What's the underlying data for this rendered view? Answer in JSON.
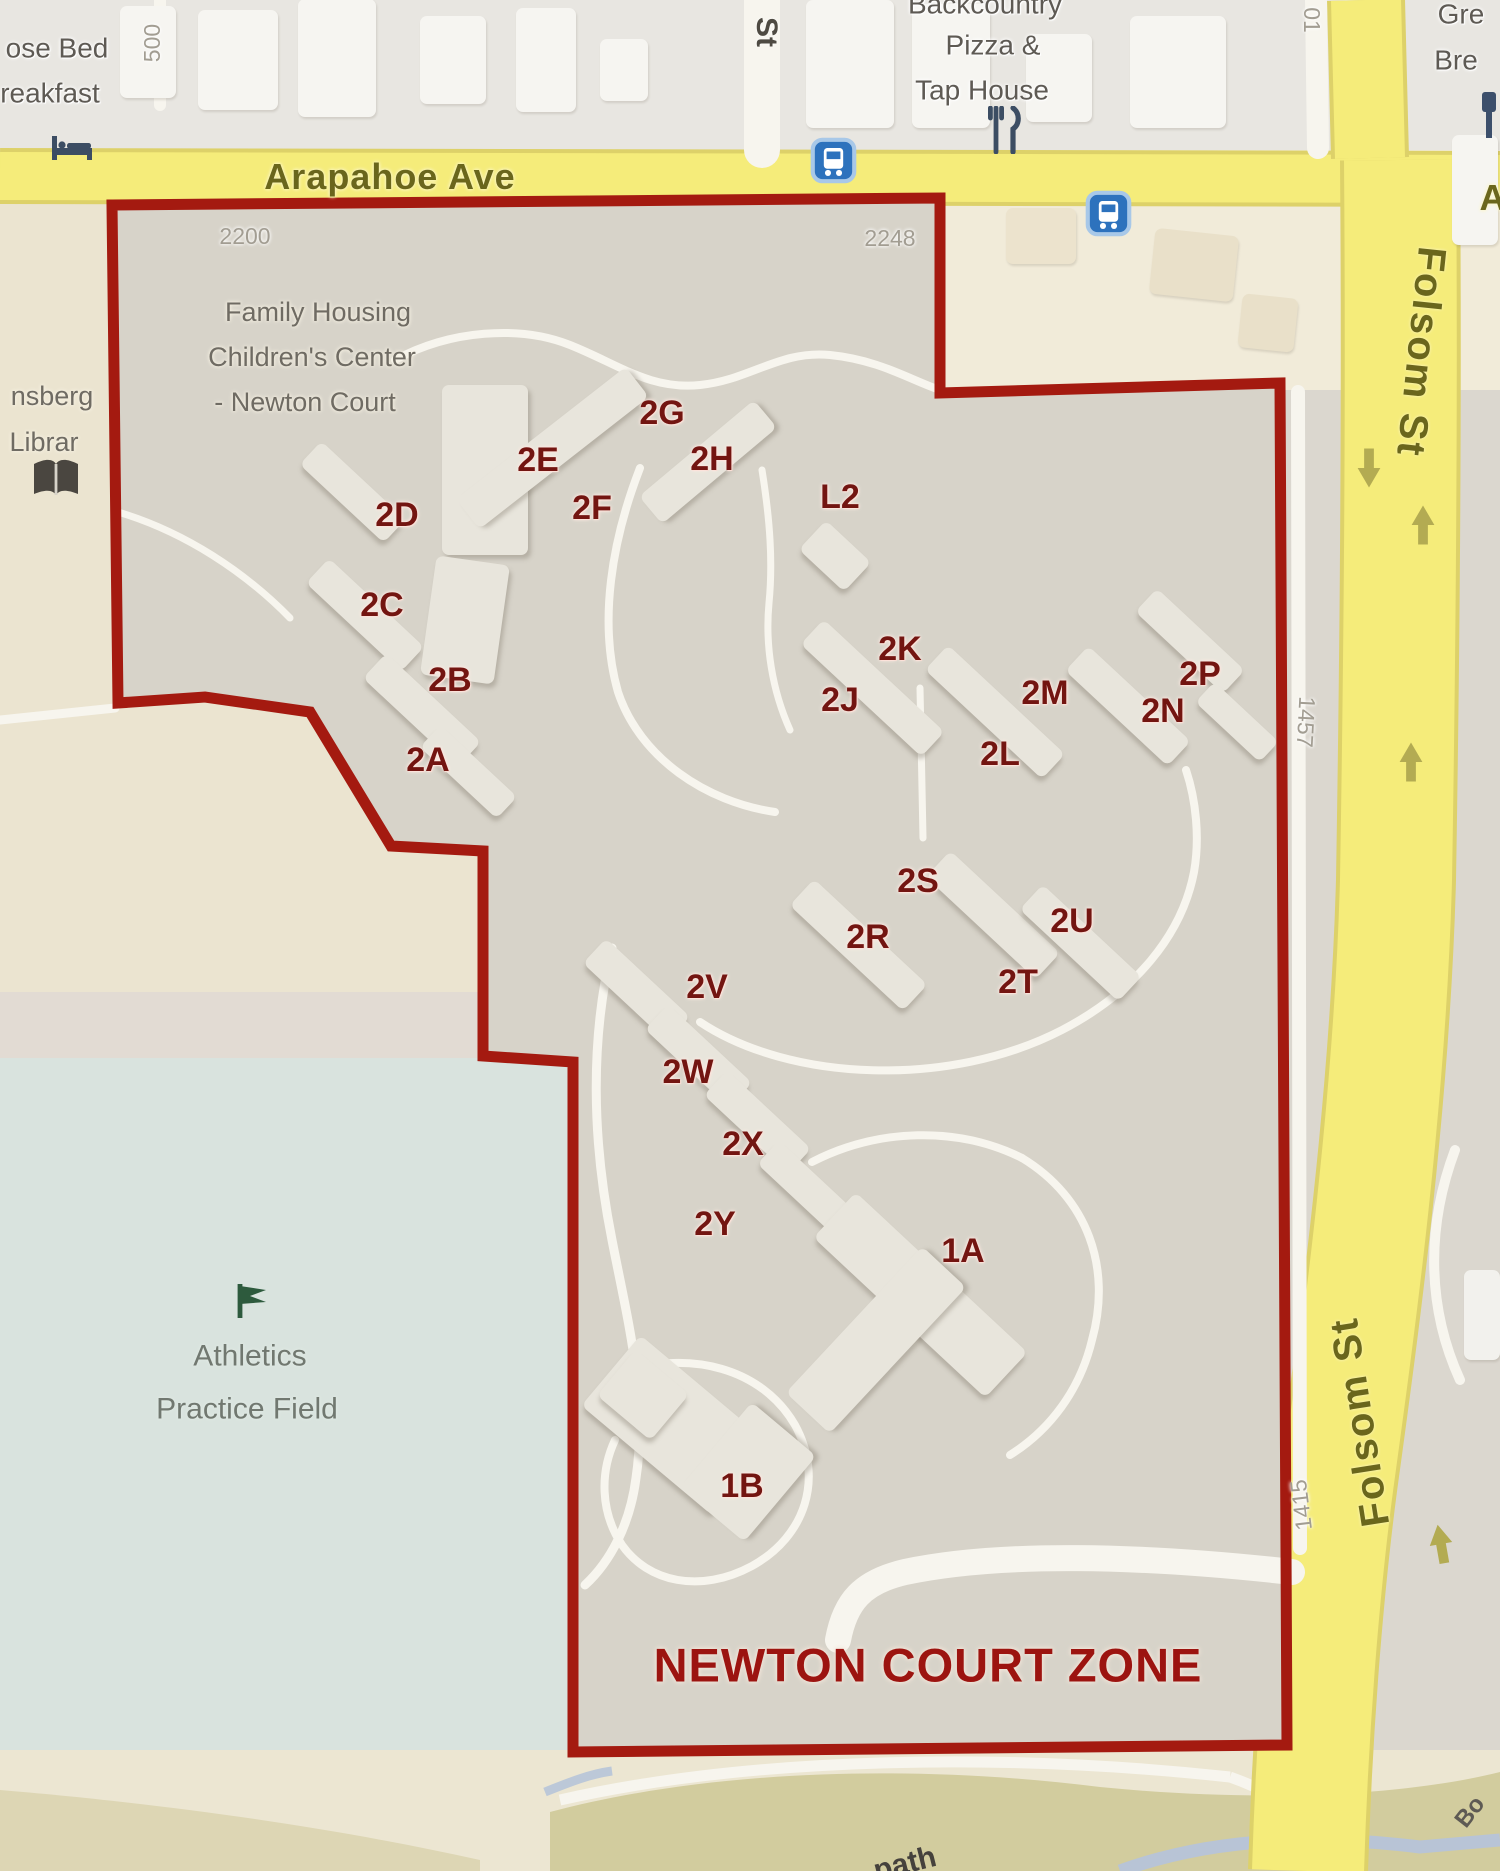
{
  "map": {
    "title": "NEWTON COURT ZONE",
    "colors": {
      "zone_fill": "#d7d3c9",
      "boundary_red": "#a41a10",
      "road_yellow": "#f5ec7a",
      "field_blue_green": "#d9e3de",
      "building_label_red": "#731511",
      "street_label_olive": "#6a661c",
      "cream_outside": "#ebe4d0",
      "creek_blue": "#b8c4d6"
    },
    "streets": [
      {
        "label": "Arapahoe Ave"
      },
      {
        "label": "Folsom St"
      },
      {
        "label": "Folsom St"
      },
      {
        "label": "St"
      },
      {
        "label": "A"
      }
    ],
    "street_numbers": [
      "2200",
      "2248",
      "500",
      "01",
      "1457",
      "1415"
    ],
    "pois": [
      {
        "name": "bed-and-breakfast",
        "lines": [
          "ose Bed",
          "reakfast"
        ]
      },
      {
        "name": "pizza-tap-house",
        "lines": [
          "Backcountry",
          "Pizza &",
          "Tap House"
        ]
      },
      {
        "name": "brewery",
        "lines": [
          "Gre",
          "Bre"
        ]
      },
      {
        "name": "library",
        "lines": [
          "nsberg",
          "Librar"
        ]
      },
      {
        "name": "family-housing",
        "lines": [
          "Family Housing",
          "Children's Center",
          "- Newton Court"
        ]
      },
      {
        "name": "athletics-field",
        "lines": [
          "Athletics",
          "Practice Field"
        ]
      },
      {
        "name": "creek-path",
        "lines": [
          "path"
        ]
      },
      {
        "name": "boulder-creek",
        "lines": [
          "Bo"
        ]
      }
    ],
    "zone_buildings": [
      "2A",
      "2B",
      "2C",
      "2D",
      "2E",
      "2F",
      "2G",
      "2H",
      "L2",
      "2J",
      "2K",
      "2L",
      "2M",
      "2N",
      "2P",
      "2R",
      "2S",
      "2T",
      "2U",
      "2V",
      "2W",
      "2X",
      "2Y",
      "1A",
      "1B"
    ]
  },
  "labels": [
    {
      "name": "street-label-arapahoe",
      "text": "Arapahoe Ave",
      "x": 390,
      "y": 177,
      "cls": "street"
    },
    {
      "name": "street-label-arapahoe-east",
      "text": "A",
      "x": 1493,
      "y": 198,
      "cls": "street"
    },
    {
      "name": "street-label-folsom-top",
      "text": "Folsom St",
      "x": 1421,
      "y": 352,
      "cls": "streetv",
      "rot": 96
    },
    {
      "name": "street-label-folsom-bottom",
      "text": "Folsom St",
      "x": 1360,
      "y": 1422,
      "cls": "streetv",
      "rot": -99
    },
    {
      "name": "street-label-st",
      "text": "St",
      "x": 766,
      "y": 32,
      "cls": "stv",
      "rot": 90
    },
    {
      "name": "address-2200",
      "text": "2200",
      "x": 245,
      "y": 236,
      "cls": "num"
    },
    {
      "name": "address-2248",
      "text": "2248",
      "x": 890,
      "y": 238,
      "cls": "num"
    },
    {
      "name": "address-500",
      "text": "500",
      "x": 152,
      "y": 43,
      "cls": "num",
      "rot": -90
    },
    {
      "name": "address-01",
      "text": "01",
      "x": 1312,
      "y": 20,
      "cls": "num",
      "rot": 90
    },
    {
      "name": "address-1457",
      "text": "1457",
      "x": 1306,
      "y": 722,
      "cls": "num",
      "rot": 93
    },
    {
      "name": "address-1415",
      "text": "1415",
      "x": 1301,
      "y": 1505,
      "cls": "num",
      "rot": -97
    },
    {
      "name": "poi-bed-breakfast-1",
      "text": "ose Bed",
      "x": 57,
      "y": 48,
      "cls": "poi"
    },
    {
      "name": "poi-bed-breakfast-2",
      "text": "reakfast",
      "x": 50,
      "y": 93,
      "cls": "poi"
    },
    {
      "name": "poi-pizza-1",
      "text": "Backcountry",
      "x": 985,
      "y": 4,
      "cls": "poi"
    },
    {
      "name": "poi-pizza-2",
      "text": "Pizza &",
      "x": 993,
      "y": 45,
      "cls": "poi"
    },
    {
      "name": "poi-pizza-3",
      "text": "Tap House",
      "x": 982,
      "y": 90,
      "cls": "poi"
    },
    {
      "name": "poi-brewery-1",
      "text": "Gre",
      "x": 1461,
      "y": 14,
      "cls": "poi"
    },
    {
      "name": "poi-brewery-2",
      "text": "Bre",
      "x": 1456,
      "y": 60,
      "cls": "poi"
    },
    {
      "name": "poi-library-1",
      "text": "nsberg",
      "x": 52,
      "y": 396,
      "cls": "poi2"
    },
    {
      "name": "poi-library-2",
      "text": "Librar",
      "x": 44,
      "y": 442,
      "cls": "poi2"
    },
    {
      "name": "poi-family-housing-1",
      "text": "Family Housing",
      "x": 318,
      "y": 312,
      "cls": "poi2"
    },
    {
      "name": "poi-family-housing-2",
      "text": "Children's Center",
      "x": 312,
      "y": 357,
      "cls": "poi2"
    },
    {
      "name": "poi-family-housing-3",
      "text": "- Newton Court",
      "x": 305,
      "y": 402,
      "cls": "poi2"
    },
    {
      "name": "poi-athletics-1",
      "text": "Athletics",
      "x": 250,
      "y": 1356,
      "cls": "ath"
    },
    {
      "name": "poi-athletics-2",
      "text": "Practice Field",
      "x": 247,
      "y": 1409,
      "cls": "ath"
    },
    {
      "name": "poi-path",
      "text": "path",
      "x": 905,
      "y": 1864,
      "cls": "pth",
      "rot": -14
    },
    {
      "name": "poi-bo",
      "text": "Bo",
      "x": 1470,
      "y": 1812,
      "cls": "bo",
      "rot": -52
    },
    {
      "name": "zone-title",
      "text": "NEWTON COURT ZONE",
      "x": 928,
      "y": 1665,
      "cls": "zone"
    },
    {
      "name": "building-label-2E",
      "text": "2E",
      "x": 538,
      "y": 461,
      "cls": "bld"
    },
    {
      "name": "building-label-2F",
      "text": "2F",
      "x": 592,
      "y": 509,
      "cls": "bld"
    },
    {
      "name": "building-label-2G",
      "text": "2G",
      "x": 662,
      "y": 414,
      "cls": "bld"
    },
    {
      "name": "building-label-2H",
      "text": "2H",
      "x": 712,
      "y": 460,
      "cls": "bld"
    },
    {
      "name": "building-label-L2",
      "text": "L2",
      "x": 840,
      "y": 498,
      "cls": "bld"
    },
    {
      "name": "building-label-2D",
      "text": "2D",
      "x": 397,
      "y": 516,
      "cls": "bld"
    },
    {
      "name": "building-label-2C",
      "text": "2C",
      "x": 382,
      "y": 606,
      "cls": "bld"
    },
    {
      "name": "building-label-2B",
      "text": "2B",
      "x": 450,
      "y": 681,
      "cls": "bld"
    },
    {
      "name": "building-label-2A",
      "text": "2A",
      "x": 428,
      "y": 761,
      "cls": "bld"
    },
    {
      "name": "building-label-2K",
      "text": "2K",
      "x": 900,
      "y": 650,
      "cls": "bld"
    },
    {
      "name": "building-label-2J",
      "text": "2J",
      "x": 840,
      "y": 701,
      "cls": "bld"
    },
    {
      "name": "building-label-2M",
      "text": "2M",
      "x": 1045,
      "y": 694,
      "cls": "bld"
    },
    {
      "name": "building-label-2L",
      "text": "2L",
      "x": 1000,
      "y": 755,
      "cls": "bld"
    },
    {
      "name": "building-label-2P",
      "text": "2P",
      "x": 1200,
      "y": 675,
      "cls": "bld"
    },
    {
      "name": "building-label-2N",
      "text": "2N",
      "x": 1163,
      "y": 712,
      "cls": "bld"
    },
    {
      "name": "building-label-2S",
      "text": "2S",
      "x": 918,
      "y": 882,
      "cls": "bld"
    },
    {
      "name": "building-label-2R",
      "text": "2R",
      "x": 868,
      "y": 938,
      "cls": "bld"
    },
    {
      "name": "building-label-2U",
      "text": "2U",
      "x": 1072,
      "y": 922,
      "cls": "bld"
    },
    {
      "name": "building-label-2T",
      "text": "2T",
      "x": 1018,
      "y": 983,
      "cls": "bld"
    },
    {
      "name": "building-label-2V",
      "text": "2V",
      "x": 707,
      "y": 988,
      "cls": "bld"
    },
    {
      "name": "building-label-2W",
      "text": "2W",
      "x": 688,
      "y": 1073,
      "cls": "bld"
    },
    {
      "name": "building-label-2X",
      "text": "2X",
      "x": 743,
      "y": 1145,
      "cls": "bld"
    },
    {
      "name": "building-label-2Y",
      "text": "2Y",
      "x": 715,
      "y": 1225,
      "cls": "bld"
    },
    {
      "name": "building-label-1A",
      "text": "1A",
      "x": 963,
      "y": 1252,
      "cls": "bld"
    },
    {
      "name": "building-label-1B",
      "text": "1B",
      "x": 742,
      "y": 1487,
      "cls": "bld"
    }
  ]
}
